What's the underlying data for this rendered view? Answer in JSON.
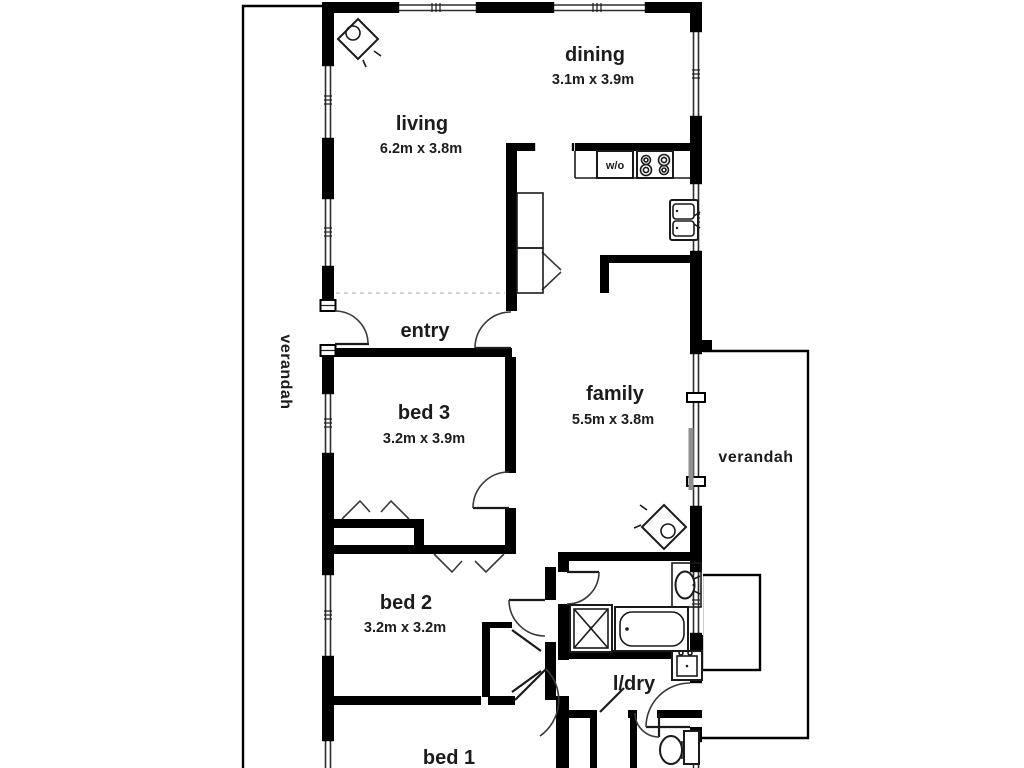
{
  "plan": {
    "title": "floor-plan",
    "rooms": [
      {
        "id": "living",
        "label": "living",
        "dims": "6.2m x 3.8m"
      },
      {
        "id": "dining",
        "label": "dining",
        "dims": "3.1m x 3.9m"
      },
      {
        "id": "entry",
        "label": "entry",
        "dims": ""
      },
      {
        "id": "family",
        "label": "family",
        "dims": "5.5m x 3.8m"
      },
      {
        "id": "bed3",
        "label": "bed 3",
        "dims": "3.2m x 3.9m"
      },
      {
        "id": "bed2",
        "label": "bed 2",
        "dims": "3.2m x 3.2m"
      },
      {
        "id": "bed1",
        "label": "bed 1",
        "dims": ""
      },
      {
        "id": "laundry",
        "label": "l/dry",
        "dims": ""
      },
      {
        "id": "verandah-left",
        "label": "verandah",
        "dims": ""
      },
      {
        "id": "verandah-right",
        "label": "verandah",
        "dims": ""
      }
    ],
    "fixtures": {
      "wall_oven": "w/o"
    },
    "colors": {
      "wall": "#000000",
      "background": "#ffffff",
      "window_line": "#2e2e2e",
      "door_line": "#3a3a3a",
      "dashed_line": "#c7c7c7",
      "slider_panel": "#8f8f8f"
    }
  }
}
